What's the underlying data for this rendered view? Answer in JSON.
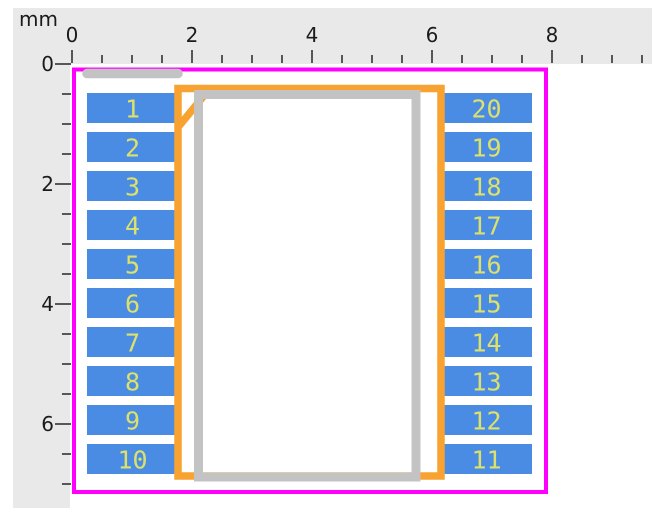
{
  "rulers": {
    "unit_label": "mm",
    "bg_color": "#E9E9E9",
    "tick_color": "#55585B",
    "label_color": "#1B1B1B",
    "horizontal": {
      "origin_px": 72,
      "tick_spacing_px": 30,
      "tick_count": 20,
      "major_every": 4,
      "major_labels": [
        "0",
        "2",
        "4",
        "6",
        "8"
      ]
    },
    "vertical": {
      "origin_px": 64,
      "tick_spacing_px": 30,
      "tick_count": 15,
      "major_every": 4,
      "major_labels": [
        "0",
        "2",
        "4",
        "6"
      ]
    }
  },
  "footprint": {
    "courtyard": {
      "color": "#FF00FF",
      "x": 74,
      "y": 69.5,
      "width": 472,
      "height": 422.5,
      "stroke_width": 4
    },
    "fab": {
      "color": "#F8A331",
      "body": {
        "x": 178,
        "y": 88.5,
        "width": 263,
        "height": 387.5,
        "stroke_width": 7.5
      },
      "pin1_chamfer": {
        "x1": 207,
        "y1": 92,
        "x2": 179,
        "y2": 126,
        "stroke_width": 7.5
      }
    },
    "silkscreen": {
      "color": "#C3C3C3",
      "body": {
        "x": 198.5,
        "y": 94.5,
        "width": 217.5,
        "height": 382.5,
        "stroke_width": 9
      },
      "pin1_bar": {
        "x1": 87,
        "y1": 73.5,
        "x2": 178,
        "y2": 73.5,
        "stroke_width": 9.5
      }
    },
    "pads": {
      "fill_color": "#4A8BE4",
      "number_color": "#DCE16A",
      "width": 91,
      "height": 30,
      "first_row_y": 93,
      "row_pitch": 39,
      "left_x": 87,
      "right_x": 441,
      "left_numbers": [
        "1",
        "2",
        "3",
        "4",
        "5",
        "6",
        "7",
        "8",
        "9",
        "10"
      ],
      "right_numbers": [
        "20",
        "19",
        "18",
        "17",
        "16",
        "15",
        "14",
        "13",
        "12",
        "11"
      ]
    }
  }
}
